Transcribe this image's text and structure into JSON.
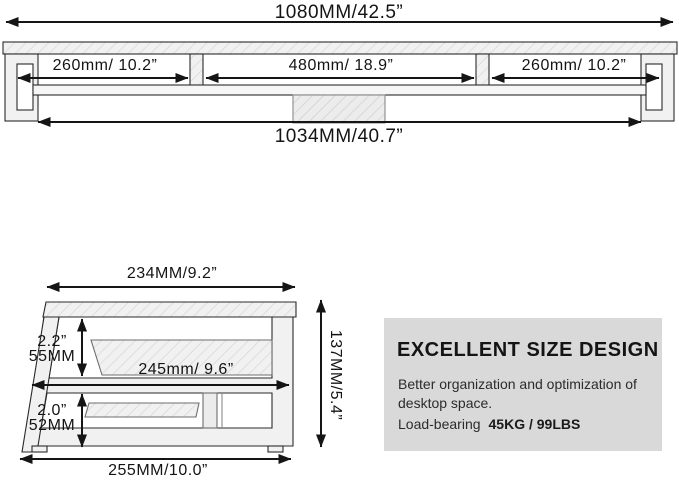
{
  "top_view": {
    "overall_width": "1080MM/42.5”",
    "sections": [
      {
        "label": "260mm/ 10.2”"
      },
      {
        "label": "480mm/ 18.9”"
      },
      {
        "label": "260mm/ 10.2”"
      }
    ],
    "inner_width": "1034MM/40.7”"
  },
  "side_view": {
    "top_width": "234MM/9.2”",
    "upper_clearance_in": "2.2”",
    "upper_clearance_mm": "55MM",
    "shelf_width": "245mm/ 9.6”",
    "lower_clearance_in": "2.0”",
    "lower_clearance_mm": "52MM",
    "bottom_width": "255MM/10.0”",
    "total_height": "137MM/5.4”"
  },
  "info_box": {
    "title": "EXCELLENT SIZE DESIGN",
    "desc_line1": "Better organization and optimization of",
    "desc_line2": "desktop space.",
    "load_label": "Load-bearing",
    "load_value": "45KG / 99LBS"
  },
  "colors": {
    "background": "#ffffff",
    "line": "#1c1c1c",
    "structure_fill": "#f1f1f1",
    "info_box_bg": "#d9d9d9",
    "text": "#141414"
  }
}
